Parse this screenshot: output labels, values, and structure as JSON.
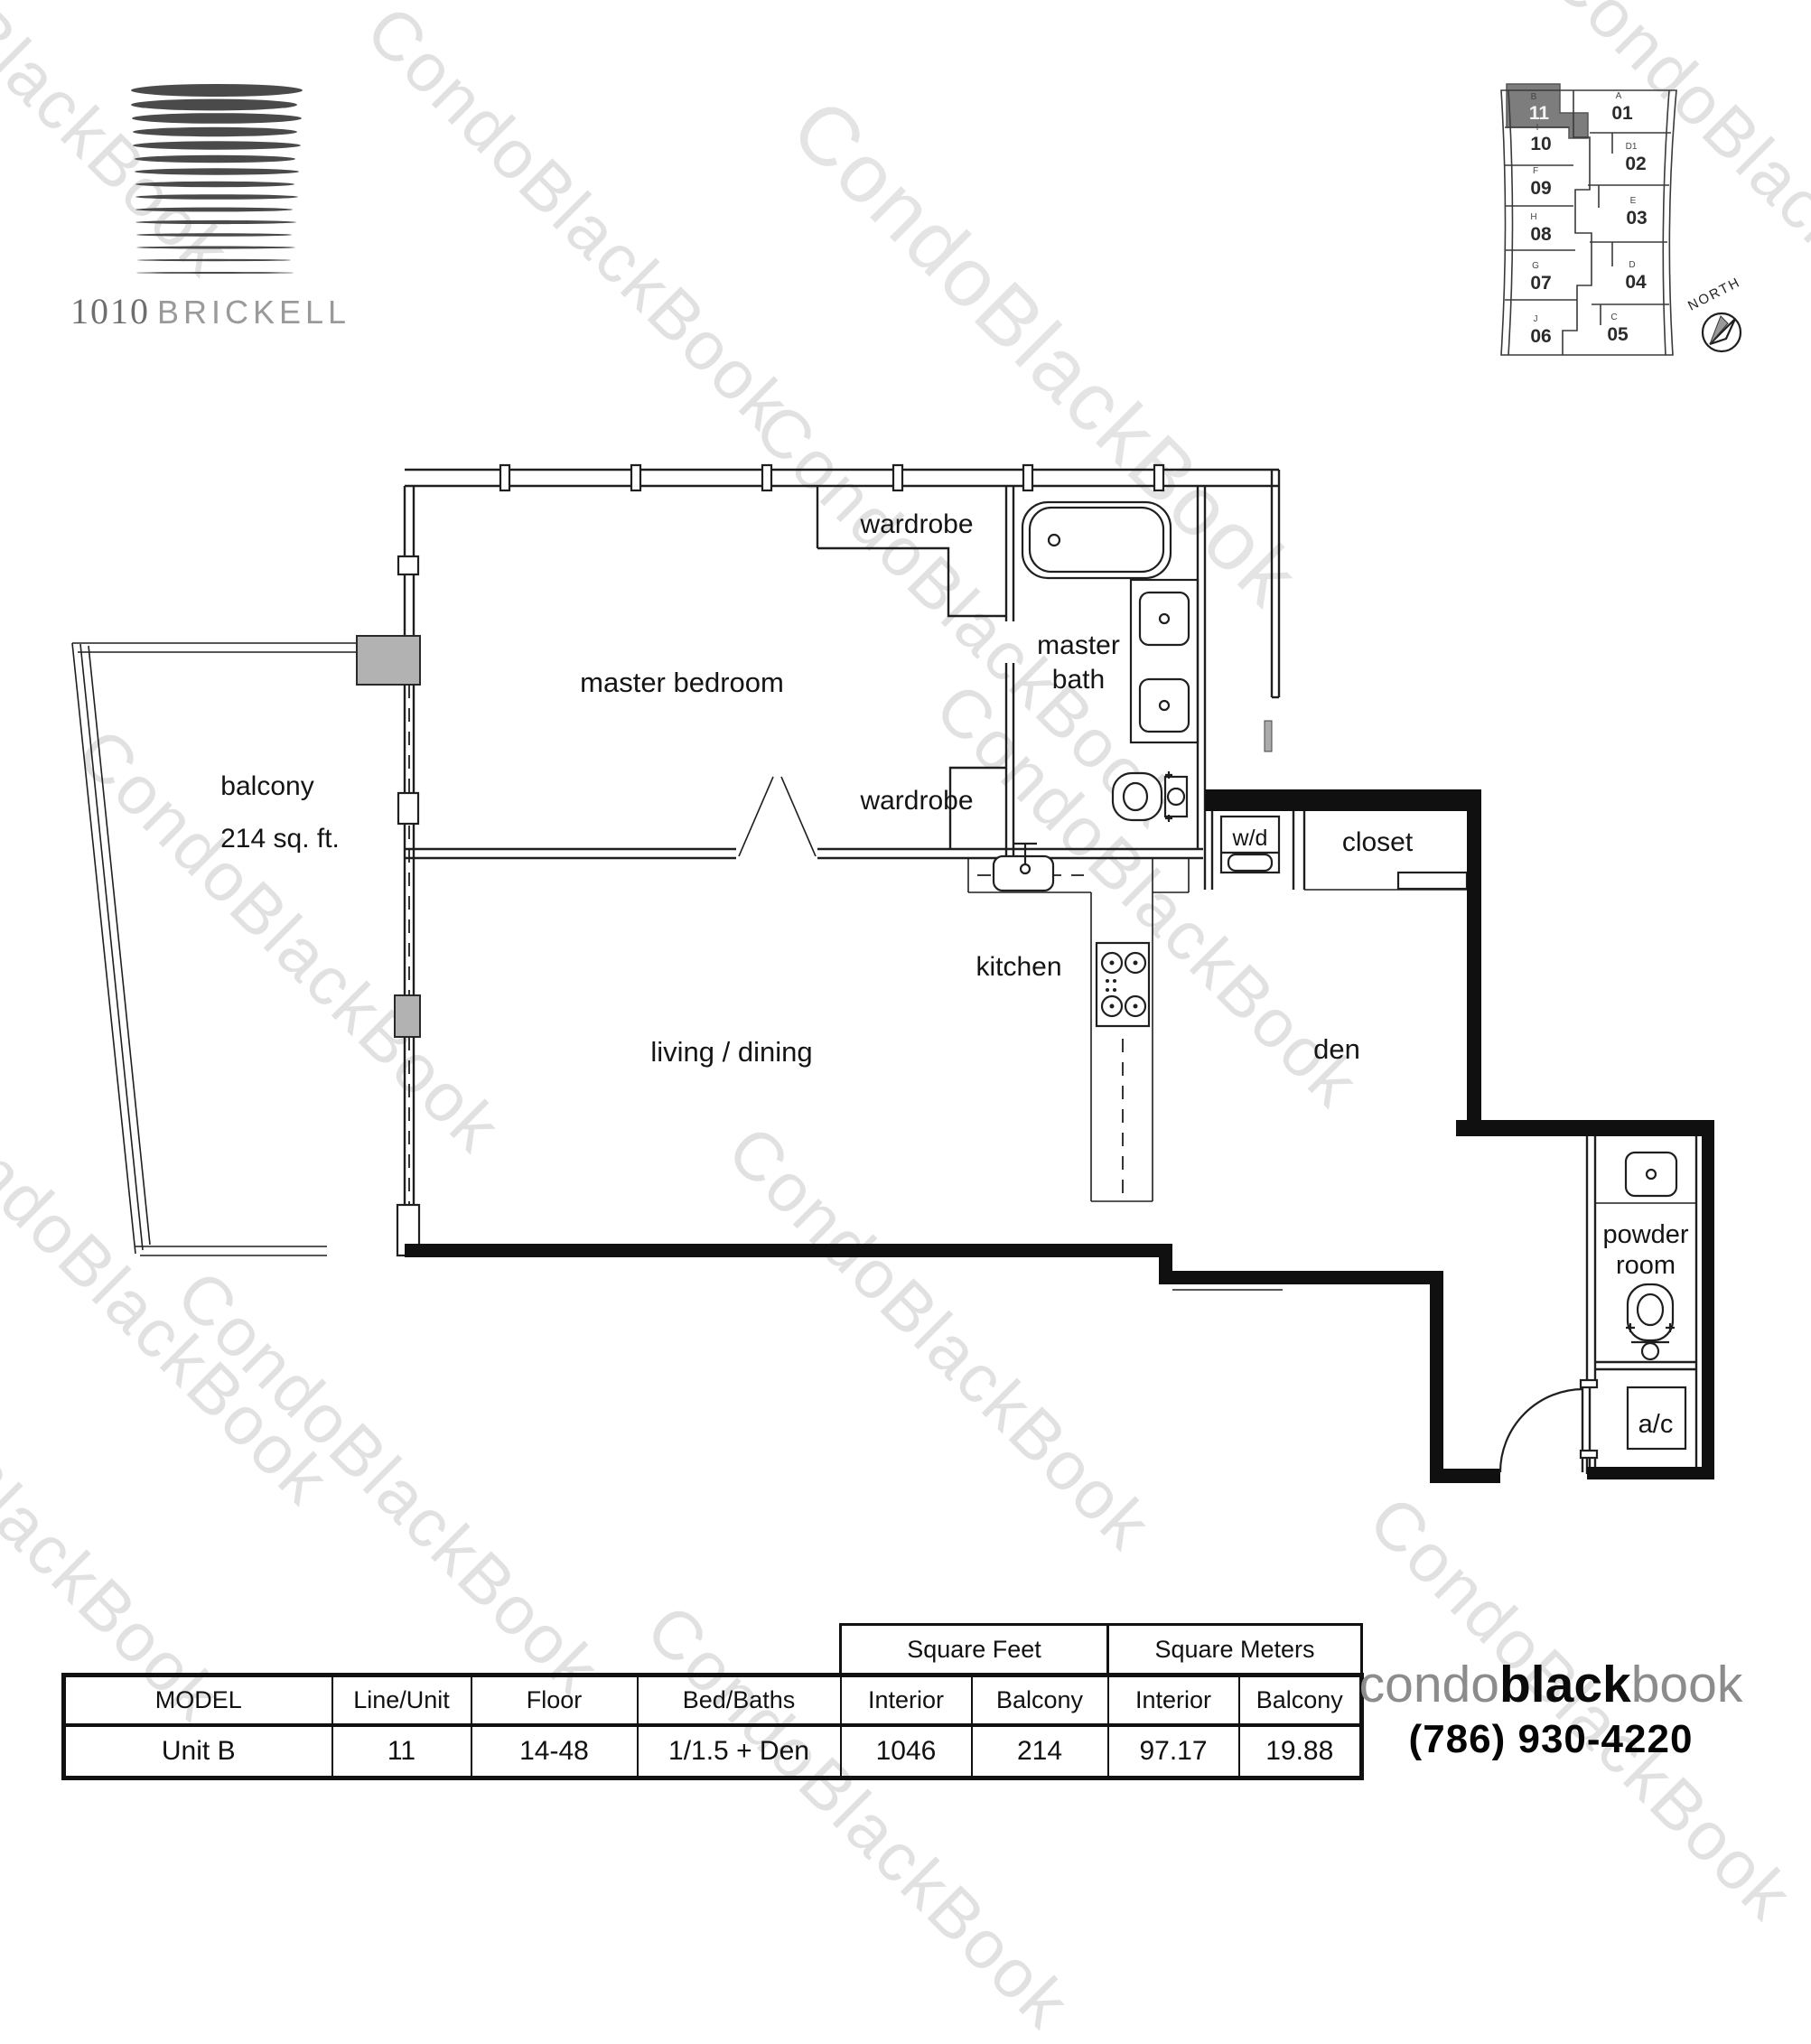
{
  "branding_top": {
    "building_number": "1010",
    "building_name": "BRICKELL"
  },
  "watermark": {
    "text": "CondoBlackBook"
  },
  "keyplan": {
    "north_label": "NORTH",
    "highlighted_unit": "11",
    "left_units": [
      {
        "letter": "B",
        "number": "11"
      },
      {
        "letter": "I",
        "number": "10"
      },
      {
        "letter": "F",
        "number": "09"
      },
      {
        "letter": "H",
        "number": "08"
      },
      {
        "letter": "G",
        "number": "07"
      },
      {
        "letter": "J",
        "number": "06"
      }
    ],
    "right_units": [
      {
        "letter": "A",
        "number": "01"
      },
      {
        "letter": "D1",
        "number": "02"
      },
      {
        "letter": "E",
        "number": "03"
      },
      {
        "letter": "D",
        "number": "04"
      },
      {
        "letter": "C",
        "number": "05"
      }
    ]
  },
  "floor_plan": {
    "rooms": {
      "balcony": "balcony",
      "balcony_area": "214 sq. ft.",
      "master_bedroom": "master bedroom",
      "wardrobe_top": "wardrobe",
      "wardrobe_bottom": "wardrobe",
      "master_bath_line1": "master",
      "master_bath_line2": "bath",
      "washer_dryer": "w/d",
      "closet": "closet",
      "kitchen": "kitchen",
      "living_dining": "living / dining",
      "den": "den",
      "powder_line1": "powder",
      "powder_line2": "room",
      "ac": "a/c"
    }
  },
  "table": {
    "group_headers": [
      "Square Feet",
      "Square Meters"
    ],
    "columns": [
      "MODEL",
      "Line/Unit",
      "Floor",
      "Bed/Baths",
      "Interior",
      "Balcony",
      "Interior",
      "Balcony"
    ],
    "rows": [
      [
        "Unit B",
        "11",
        "14-48",
        "1/1.5 + Den",
        "1046",
        "214",
        "97.17",
        "19.88"
      ]
    ]
  },
  "branding_bottom": {
    "wordmark": [
      "condo",
      "black",
      "book"
    ],
    "phone": "(786) 930-4220"
  }
}
